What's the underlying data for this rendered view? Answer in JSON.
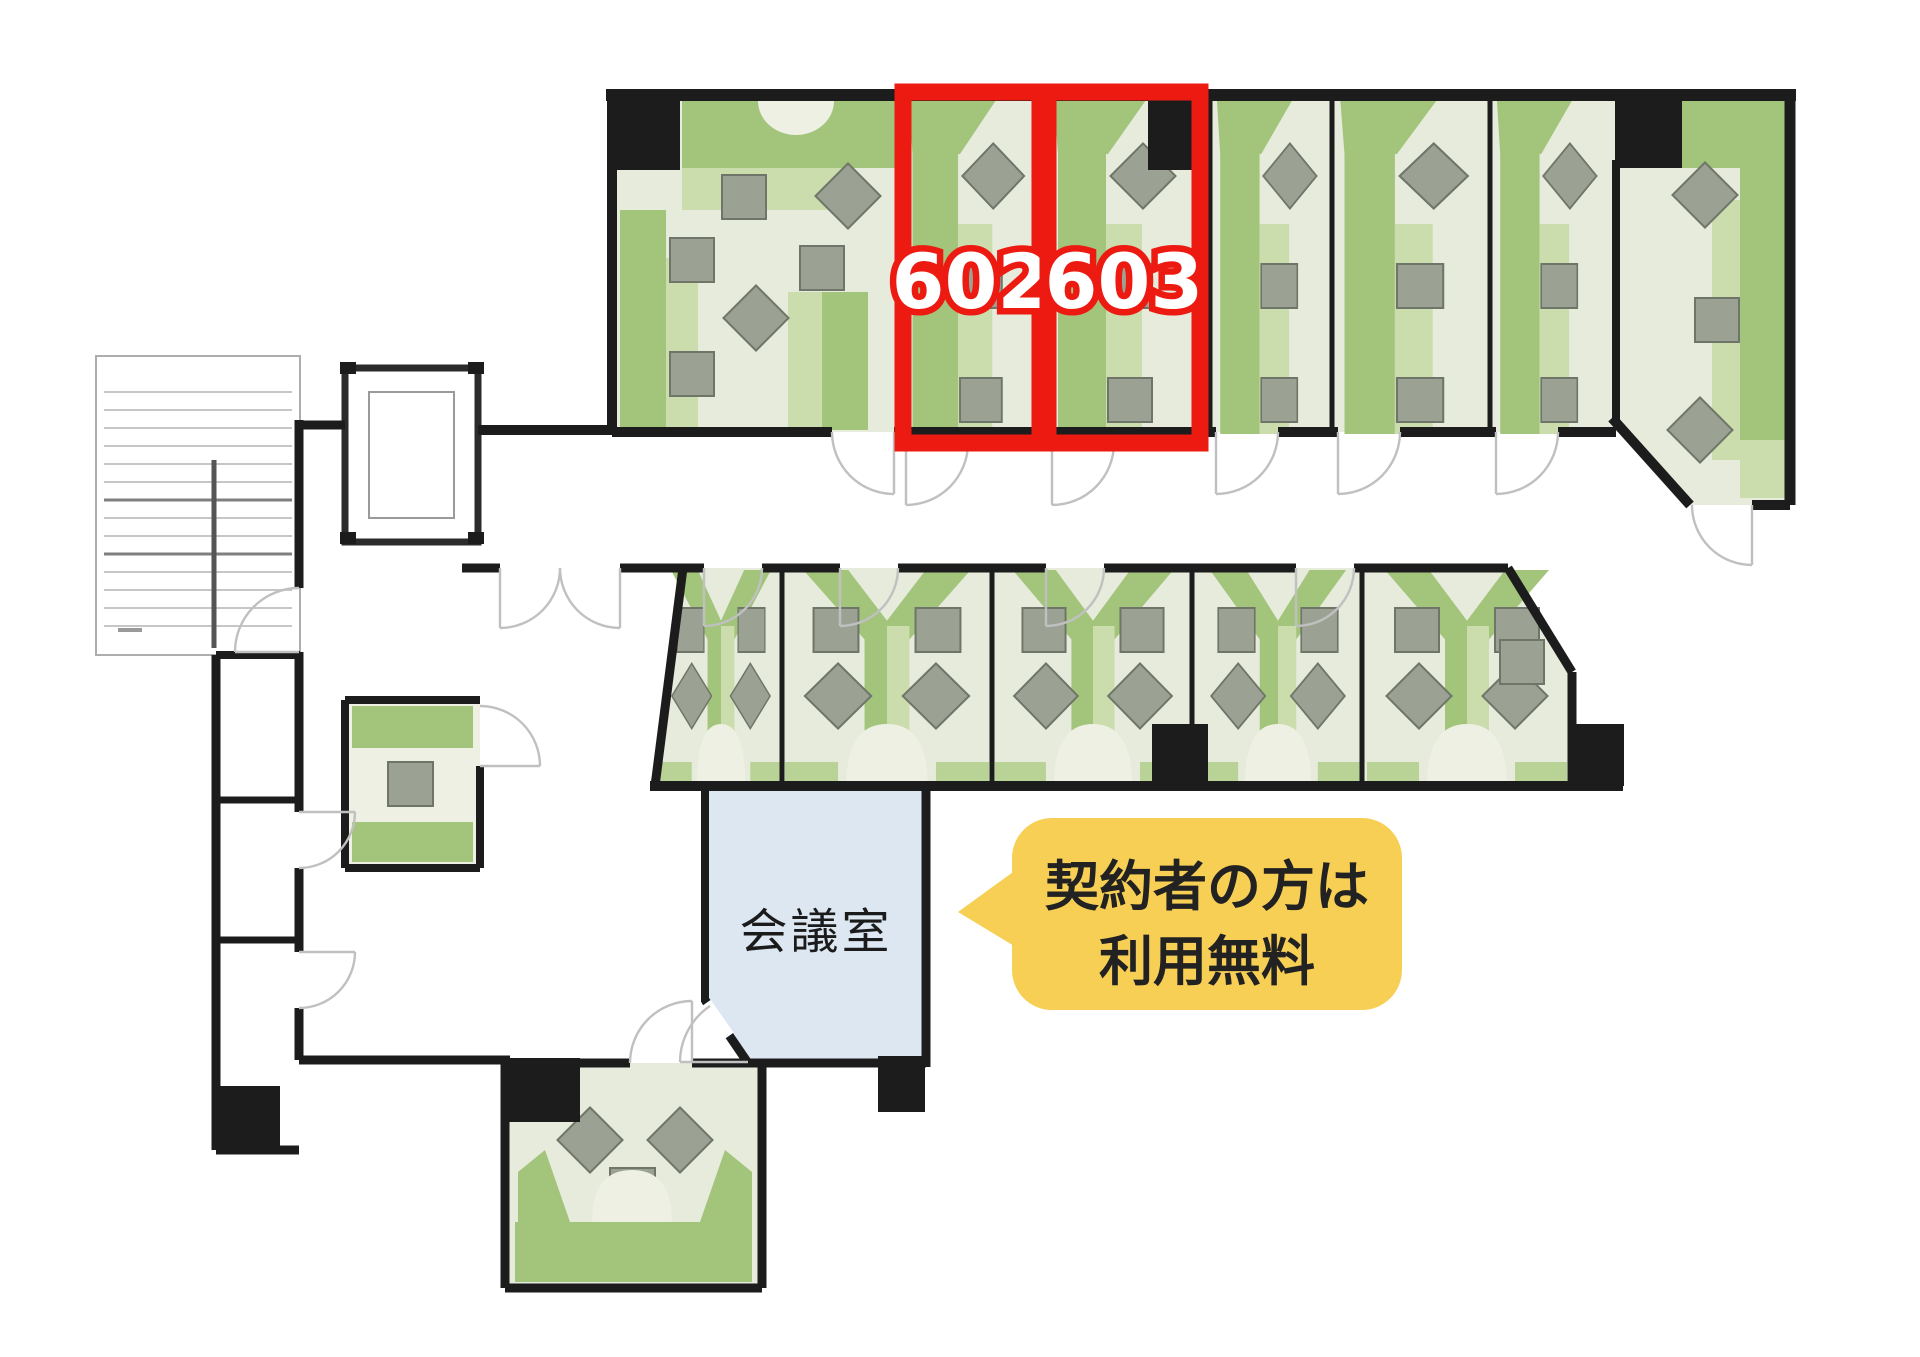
{
  "floor_plan": {
    "type": "office-floor-plan",
    "highlighted_rooms": [
      {
        "id": "room-602",
        "label": "602"
      },
      {
        "id": "room-603",
        "label": "603"
      }
    ],
    "labels": {
      "meeting_room": "会議室"
    },
    "callout": {
      "line1": "契約者の方は",
      "line2": "利用無料"
    },
    "colors": {
      "highlight-red": "#ec1a10",
      "room-number-text": "#ffffff",
      "callout-yellow": "#f7cf55",
      "callout-text": "#222222",
      "meeting-room-blue": "#dde7f2",
      "desk-green": "#a3c47b",
      "desk-green-light": "#cbddad",
      "corner-band-green": "#b9d295",
      "floor": "#e6ebdc",
      "floor-arch": "#edf0e3",
      "wall": "#1c1c1c",
      "chair": "#9ba294",
      "chair-border": "#6f7669",
      "door-arc": "#c0c0c0",
      "stair-line": "#b3b3b3"
    }
  }
}
